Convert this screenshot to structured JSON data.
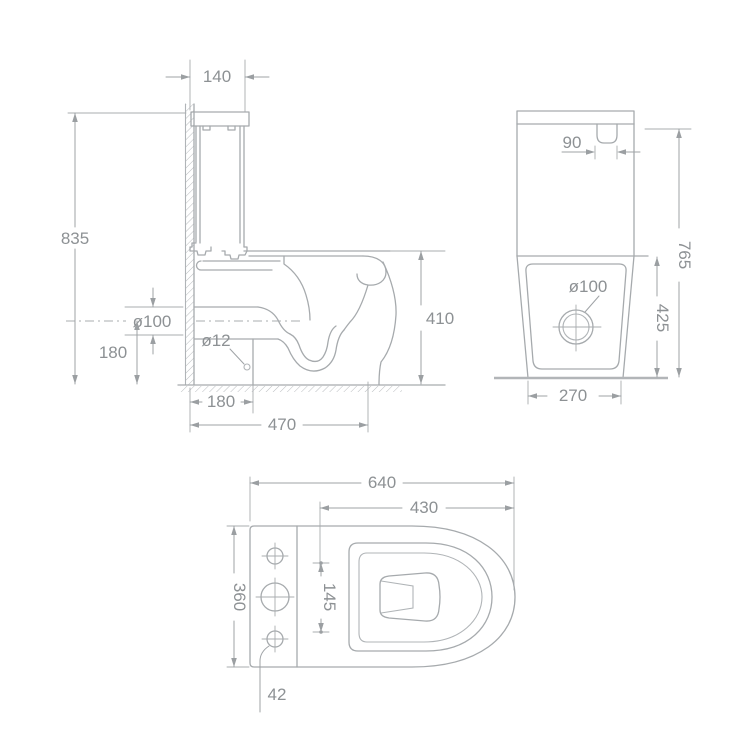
{
  "drawing": {
    "type": "technical dimension drawing",
    "subject": "two-piece back-to-wall toilet: side section, rear elevation and plan views",
    "units": "mm",
    "side_view": {
      "cistern_depth": "140",
      "overall_height": "835",
      "outlet_diameter": "ø100",
      "outlet_center_height": "180",
      "rim_height": "410",
      "fixing_hole_diameter": "ø12",
      "outlet_setout_from_wall": "180",
      "overall_depth": "470"
    },
    "rear_view": {
      "flush_button_width": "90",
      "overall_height": "765",
      "outlet_diameter": "ø100",
      "lower_body_height": "425",
      "base_width": "270"
    },
    "plan_view": {
      "overall_length": "640",
      "bowl_length": "430",
      "overall_width": "360",
      "hinge_hole_spacing": "145",
      "hole_dimension": "42"
    },
    "colors": {
      "background": "#ffffff",
      "geometry_line": "#a6aaad",
      "dimension_line": "#9fa3a6",
      "text": "#8d9194"
    }
  }
}
